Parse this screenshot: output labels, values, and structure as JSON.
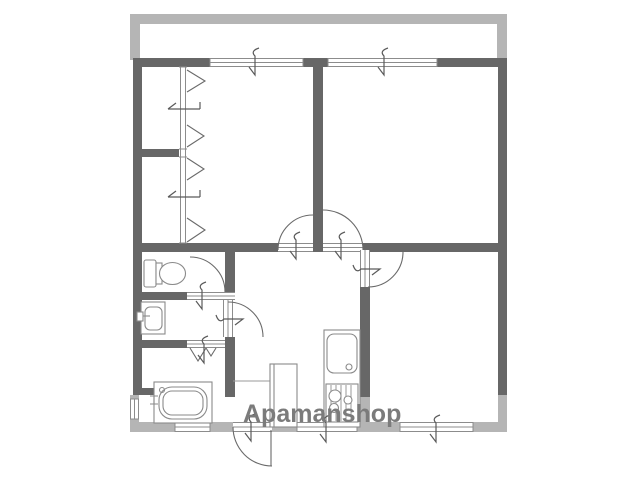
{
  "watermark": {
    "text": "Apamanshop",
    "color": "#7b7b7b"
  },
  "colors": {
    "background": "#ffffff",
    "wall": "#676767",
    "balcony_wall": "#b5b5b5",
    "door_arc_line": "#6a6a6a",
    "opening_line": "#8c8c8c",
    "fixture_line": "#8a8a8a",
    "watermark": "#7b7b7b"
  },
  "floor_plan": {
    "type": "apartment-floor-plan",
    "areas": [
      "balcony-top",
      "room-upper-left",
      "room-upper-right",
      "closets-left",
      "toilet-room",
      "washroom",
      "bathroom",
      "hall-kitchen",
      "entrance",
      "room-lower-right"
    ],
    "fixtures": [
      "toilet",
      "washbasin",
      "bathtub",
      "kitchen-sink",
      "gas-stove",
      "shoe-cabinet"
    ],
    "openings": [
      "sliding-windows",
      "hinged-doors",
      "double-hall-doors",
      "folding-bath-door",
      "closet-folding-doors",
      "entrance-door"
    ]
  }
}
